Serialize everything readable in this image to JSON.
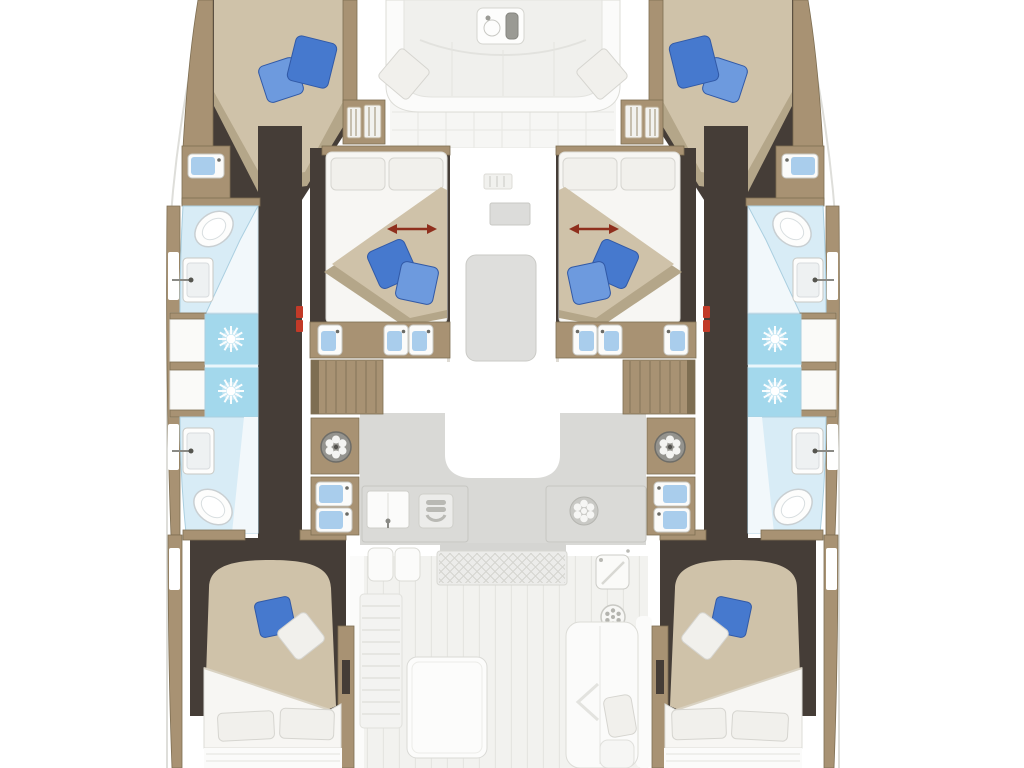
{
  "diagram": {
    "type": "floor-plan",
    "subject": "Catamaran yacht interior deck plan, top-down view, no text labels",
    "rooms": [
      "forward-cockpit",
      "bow-cabin-port",
      "bow-cabin-starboard",
      "mid-cabin-port",
      "mid-cabin-starboard",
      "bathroom-forward-port",
      "bathroom-aft-port",
      "bathroom-forward-starboard",
      "bathroom-aft-starboard",
      "shower-stalls-port",
      "shower-stalls-starboard",
      "hull-corridor-port",
      "hull-corridor-starboard",
      "salon-galley",
      "aft-cockpit",
      "aft-cabin-port",
      "aft-cabin-starboard"
    ],
    "fixtures": [
      "double-bed",
      "pillow",
      "toilet",
      "washbasin",
      "vanity-sink",
      "shower-head",
      "staircase",
      "washing-machine",
      "galley-sink",
      "stove",
      "burner",
      "cockpit-table",
      "bench-seat",
      "deck-hatch",
      "grating",
      "cockpit-fridge",
      "louvered-locker",
      "hull-window"
    ],
    "counts": {
      "double_beds": 6,
      "toilets": 4,
      "shower_stalls": 4,
      "staircases": 2,
      "washing_machines": 2
    },
    "annotations": {
      "bed_slide_arrows": 2,
      "arrow_style": "double-headed red arrow on mid-cabin beds"
    }
  },
  "colors": {
    "wood": "#a89273",
    "wood_dark": "#7e6e52",
    "floor_dark": "#453d37",
    "bed_beige": "#cfc2a9",
    "bed_beige_shadow": "#b4a689",
    "linen": "#f7f6f3",
    "pillow_white": "#f1f0ec",
    "pillow_blue": "#4679ce",
    "pillow_blue_light": "#6d9ade",
    "pillow_blue_dark": "#3159a6",
    "bath_floor": "#d8ecf6",
    "bath_stroke": "#abcfe0",
    "shower_blue": "#a3d8ec",
    "sink_blue": "#a9cdec",
    "salon_floor": "#d9d9d6",
    "cockpit_floor": "#f2f2ef",
    "furniture_white": "#fbfbfa",
    "furniture_stroke": "#dcdcd7",
    "metal_gray": "#9a9a94",
    "arrow_red": "#8f2f1d",
    "door_red": "#c23a28",
    "hull_line": "#dededa",
    "washer_gray": "#94938e",
    "background": "#ffffff"
  }
}
